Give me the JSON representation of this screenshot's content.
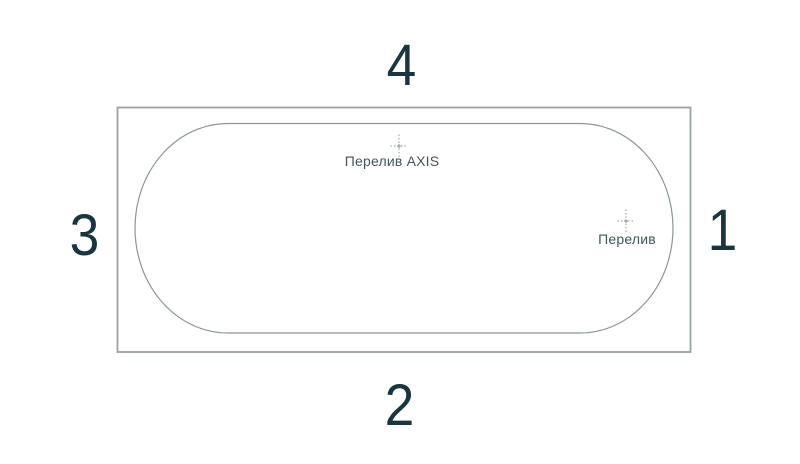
{
  "diagram": {
    "kind": "bathtub-top-view-drawing",
    "colors": {
      "background": "#ffffff",
      "outer_outline": "#98a2a2",
      "inner_outline": "#8a9795",
      "center_mark": "#83908f",
      "label_text": "#43565b",
      "number_text": "#19353f"
    },
    "sides": [
      {
        "label": "1",
        "position": "right"
      },
      {
        "label": "2",
        "position": "bottom"
      },
      {
        "label": "3",
        "position": "left"
      },
      {
        "label": "4",
        "position": "top"
      }
    ],
    "markers": [
      {
        "name": "overflow-axis",
        "label": "Перелив AXIS"
      },
      {
        "name": "overflow",
        "label": "Перелив"
      }
    ]
  }
}
